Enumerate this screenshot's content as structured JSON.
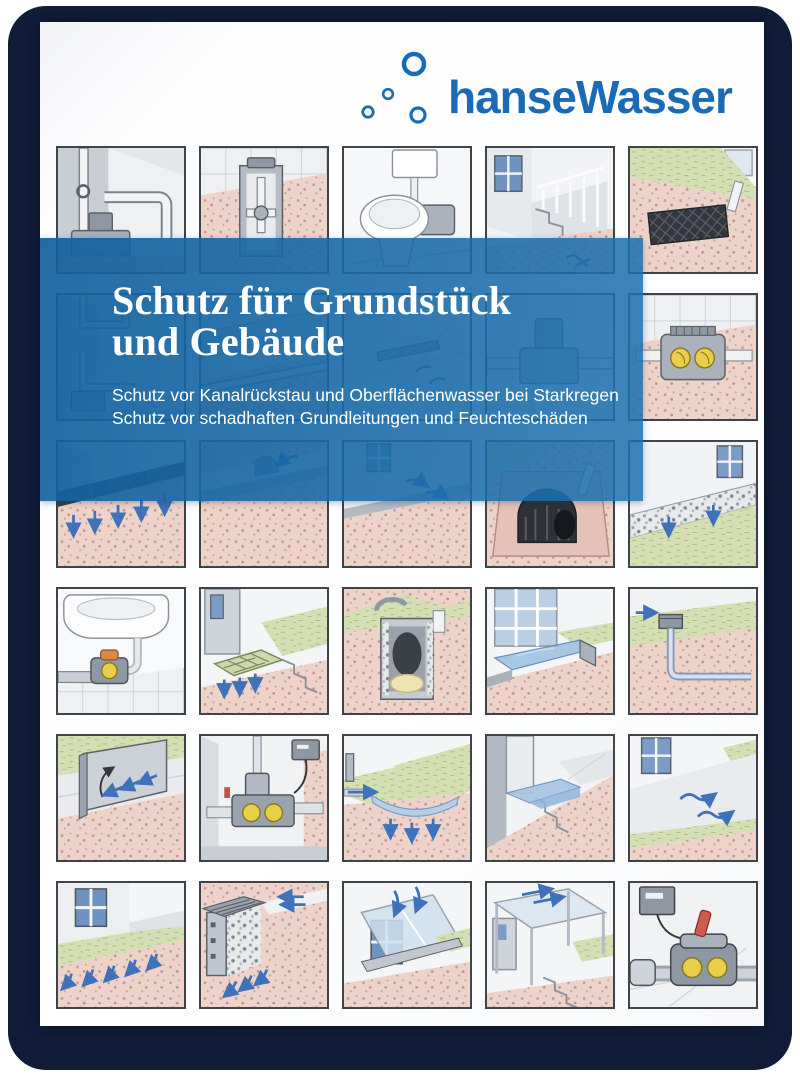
{
  "brand": {
    "logo_text": "hanseWasser",
    "logo_color": "#1a6ab5",
    "bubbles_icon": "water-bubbles-icon"
  },
  "banner": {
    "title_line1": "Schutz für Grundstück",
    "title_line2": "und Gebäude",
    "subtitle_line1": "Schutz vor Kanalrückstau und Oberflächenwasser bei Starkregen",
    "subtitle_line2": "Schutz vor schadhaften Grundleitungen und Feuchteschäden",
    "background_color": "#1768a5",
    "text_color": "#ffffff"
  },
  "cover": {
    "card_color": "#101c38",
    "paper_color": "#fdfdfe"
  },
  "palette": {
    "soil_pink": "#eed3cb",
    "soil_dot": "#c69a8e",
    "grass_green": "#d4dfb4",
    "water_blue": "#3f72b8",
    "water_light": "#a9c6e2",
    "concrete_grey": "#c2c7cf",
    "metal_grey": "#8f97a3",
    "valve_yellow": "#e8cf4a",
    "alert_red": "#cf5a4e",
    "crate_black": "#33373d",
    "outline": "#4e545c"
  },
  "grid": {
    "rows": 6,
    "cols": 5,
    "tiles": [
      {
        "scene": "sewage-lifting-station"
      },
      {
        "scene": "backflow-valve-shaft"
      },
      {
        "scene": "toilet-lifting-unit"
      },
      {
        "scene": "basement-stairwell"
      },
      {
        "scene": "infiltration-crate"
      },
      {
        "scene": "downpipe-backflow-loop"
      },
      {
        "scene": "underfloor-drain-pipe"
      },
      {
        "scene": "terrace-drain-channel"
      },
      {
        "scene": "sewage-pump"
      },
      {
        "scene": "floor-drain-backflow-flaps"
      },
      {
        "scene": "drainage-mat-seepage"
      },
      {
        "scene": "lawn-drain-dome"
      },
      {
        "scene": "terrace-edge-sealing"
      },
      {
        "scene": "infiltration-tunnel"
      },
      {
        "scene": "gravel-strip-drainage"
      },
      {
        "scene": "sink-backflow-valve"
      },
      {
        "scene": "entrance-drain-grate"
      },
      {
        "scene": "soakaway-shaft"
      },
      {
        "scene": "window-well-retention"
      },
      {
        "scene": "yard-drain-pipe"
      },
      {
        "scene": "flood-barrier-plate"
      },
      {
        "scene": "backflow-pump-unit"
      },
      {
        "scene": "infiltration-swale"
      },
      {
        "scene": "flooded-basement-stairs"
      },
      {
        "scene": "slope-away-paving"
      },
      {
        "scene": "lawn-seepage-slope"
      },
      {
        "scene": "light-shaft-drainage"
      },
      {
        "scene": "glazed-light-shaft-cover"
      },
      {
        "scene": "entrance-canopy"
      },
      {
        "scene": "backflow-valve-hand-lever"
      }
    ]
  }
}
